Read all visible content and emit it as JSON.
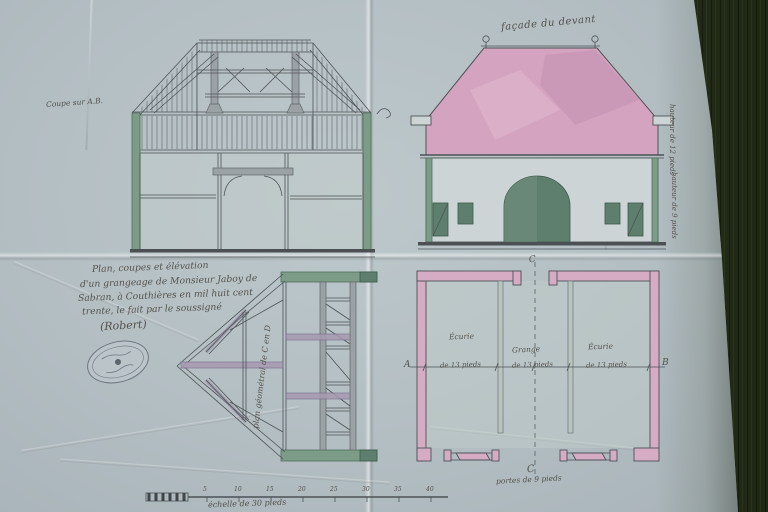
{
  "photo": {
    "description": "hand-drawn 1830 barn (grangeage) architectural drawing on folded blue-grey paper, photographed on dark wood"
  },
  "labels": {
    "section_title": "Coupe sur A.B.",
    "elevation_title": "façade du devant",
    "elevation_note_top": "hauteur de 12 pieds",
    "elevation_note_bottom": "hauteur de 9 pieds",
    "truss_note": "plan géométral de C en D",
    "plan_bottom_note": "portes de 9 pieds"
  },
  "caption": {
    "line1": "Plan, coupes et élévation",
    "line2": "d'un grangeage de Monsieur Jaboy de",
    "line3": "Sabran, à Couthières en mil huit cent",
    "line4": "trente, le fait par le soussigné",
    "signature": "(Robert)"
  },
  "plan": {
    "rooms": [
      "Écurie",
      "Grange",
      "Écurie"
    ],
    "dim_start": "A",
    "dim_end": "B",
    "segments": [
      "de 13 pieds",
      "de 13 pieds",
      "de 13 pieds"
    ],
    "axis_top": "C",
    "axis_bottom": "C"
  },
  "scale_bar": {
    "label": "échelle de 30 pieds",
    "ticks": [
      "5",
      "10",
      "15",
      "20",
      "25",
      "30",
      "35",
      "40"
    ]
  },
  "colors": {
    "paper": "#b4bfc3",
    "wood": "#2c361e",
    "ink": "#4d5356",
    "roof_pink": "#d4a3bf",
    "wall_pink": "#d6abc4",
    "wash_green": "#7d9c87",
    "wash_green_dark": "#4f6f5e",
    "wash_gray": "#9ba2a6",
    "wash_purple": "#a79ab0",
    "hand_ink": "#55524a"
  }
}
